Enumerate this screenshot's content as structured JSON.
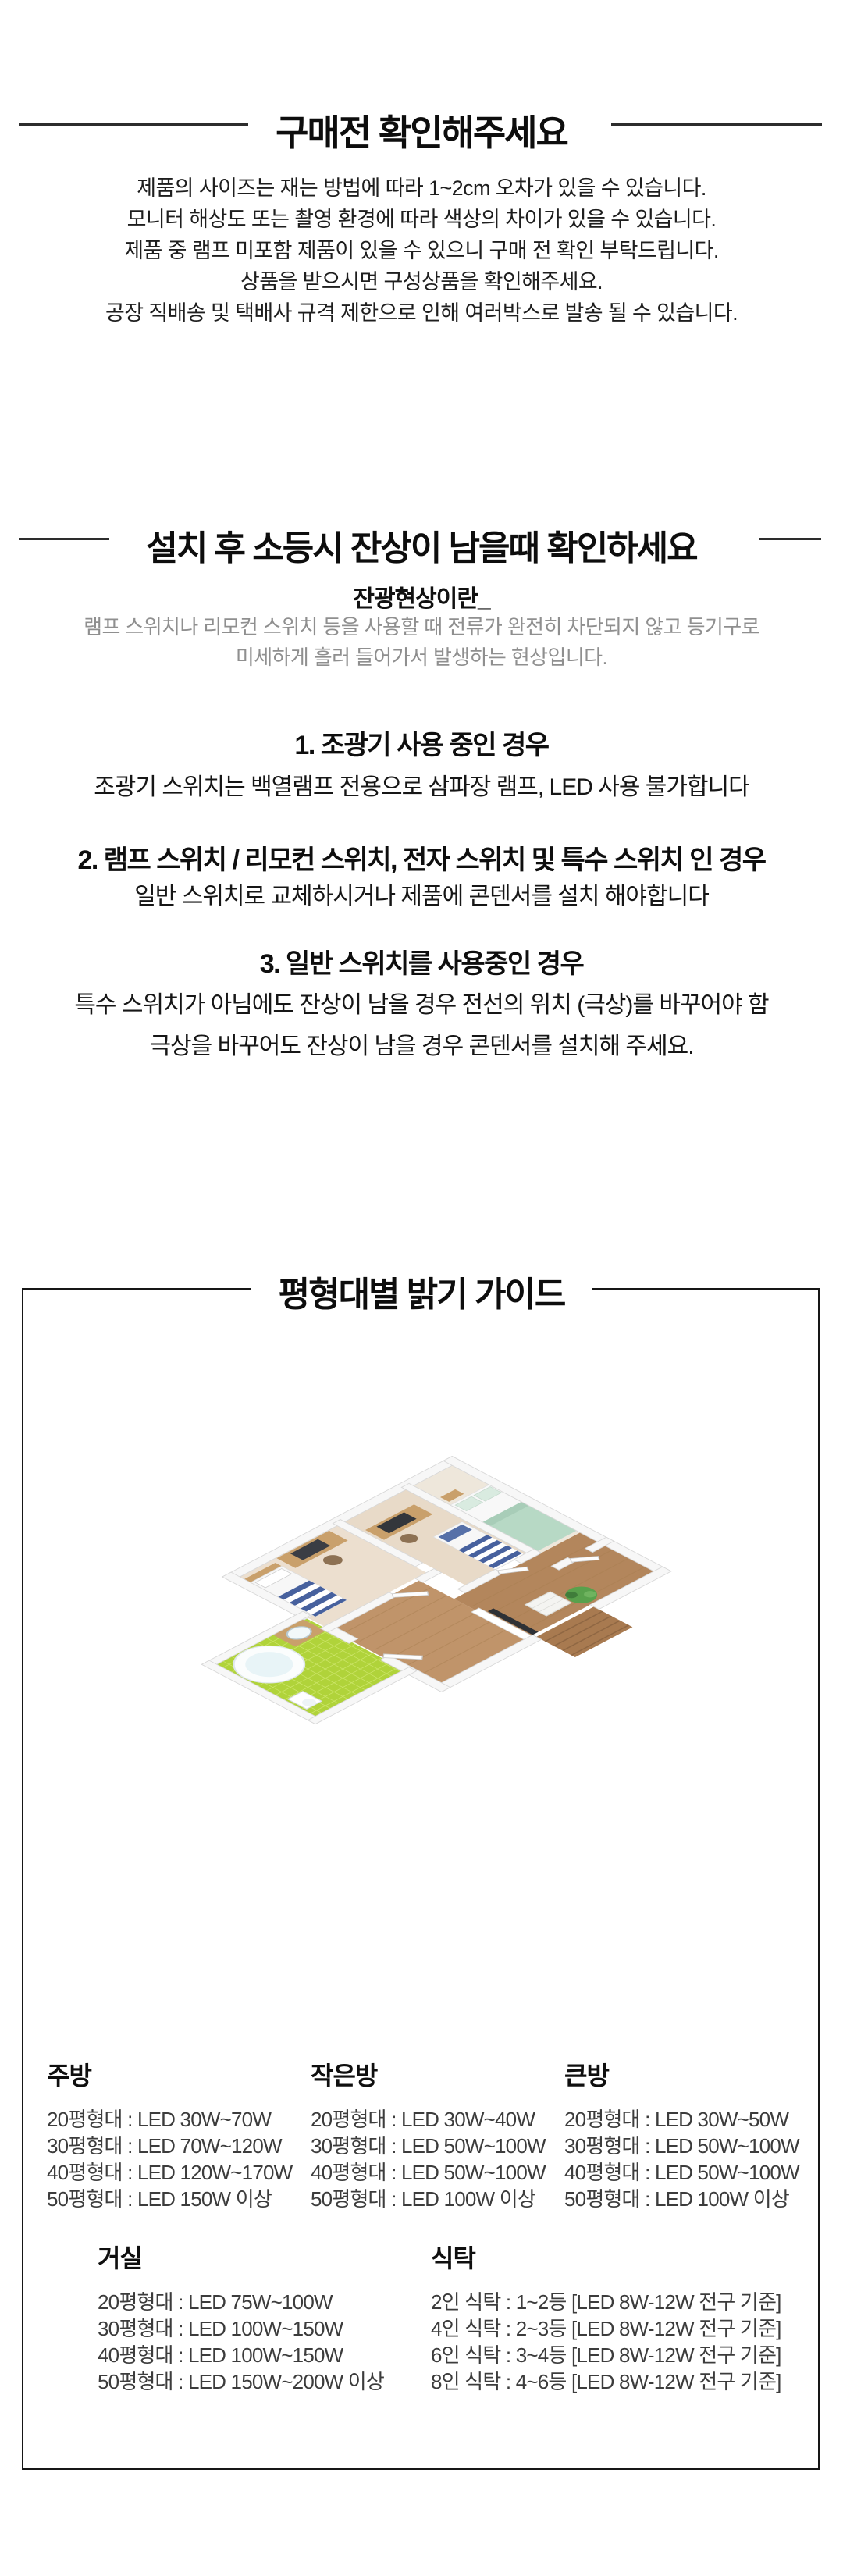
{
  "notice": {
    "title": "구매전 확인해주세요",
    "lines": [
      "제품의 사이즈는 재는 방법에 따라 1~2cm 오차가 있을 수 있습니다.",
      "모니터 해상도 또는 촬영 환경에 따라 색상의 차이가 있을 수 있습니다.",
      "제품 중 램프 미포함 제품이 있을 수 있으니 구매 전 확인 부탁드립니다.",
      "상품을 받으시면 구성상품을 확인해주세요.",
      "공장 직배송 및 택배사 규격 제한으로 인해 여러박스로 발송 될 수 있습니다."
    ]
  },
  "afterglow": {
    "title": "설치 후 소등시 잔상이 남을때 확인하세요",
    "subtitle": "잔광현상이란_",
    "desc_lines": [
      "램프 스위치나 리모컨 스위치 등을 사용할 때 전류가 완전히 차단되지 않고 등기구로",
      "미세하게 흘러 들어가서 발생하는 현상입니다."
    ],
    "cases": [
      {
        "heading": "1. 조광기 사용 중인 경우",
        "body1": "조광기 스위치는 백열램프 전용으로 삼파장 램프, LED 사용 불가합니다",
        "body2": ""
      },
      {
        "heading": "2. 램프 스위치 / 리모컨 스위치, 전자 스위치 및 특수 스위치 인 경우",
        "body1": "일반 스위치로 교체하시거나 제품에 콘덴서를 설치 해야합니다",
        "body2": ""
      },
      {
        "heading": "3. 일반 스위치를 사용중인 경우",
        "body1": "특수 스위치가 아님에도 잔상이 남을 경우 전선의 위치 (극상)를 바꾸어야 함",
        "body2": "극상을 바꾸어도 잔상이 남을 경우 콘덴서를 설치해 주세요."
      }
    ]
  },
  "guide": {
    "title": "평형대별 밝기 가이드",
    "illustration": "isometric-apartment-floorplan",
    "palette": {
      "bathroom_tile": "#b0d33a",
      "bathroom_tile_line": "#cde66b",
      "wood_floor": "#c0946a",
      "wood_floor_dark": "#b3865c",
      "pale_wood": "#ecdfcf",
      "wall_white": "#f7f7f7",
      "wall_edge": "#d8d8d8",
      "furniture_wood": "#c9a06b",
      "screen_dark": "#33363b",
      "bed_stripe_navy": "#47619e",
      "blanket_mint": "#b7d9c5",
      "plant_green": "#58a14c"
    },
    "row1": [
      {
        "name": "주방",
        "items": [
          "20평형대 : LED 30W~70W",
          "30평형대 : LED 70W~120W",
          "40평형대 : LED 120W~170W",
          "50평형대 : LED 150W 이상"
        ]
      },
      {
        "name": "작은방",
        "items": [
          "20평형대 : LED 30W~40W",
          "30평형대 : LED 50W~100W",
          "40평형대 : LED 50W~100W",
          "50평형대 : LED 100W 이상"
        ]
      },
      {
        "name": "큰방",
        "items": [
          "20평형대 : LED 30W~50W",
          "30평형대 : LED 50W~100W",
          "40평형대 : LED 50W~100W",
          "50평형대 : LED 100W 이상"
        ]
      }
    ],
    "row2": [
      {
        "name": "거실",
        "items": [
          "20평형대 : LED 75W~100W",
          "30평형대 : LED 100W~150W",
          "40평형대 : LED 100W~150W",
          "50평형대 : LED 150W~200W 이상"
        ]
      },
      {
        "name": "식탁",
        "items": [
          "2인 식탁 : 1~2등 [LED 8W-12W 전구 기준]",
          "4인 식탁 : 2~3등 [LED 8W-12W 전구 기준]",
          "6인 식탁 : 3~4등 [LED 8W-12W 전구 기준]",
          "8인 식탁 : 4~6등 [LED 8W-12W 전구 기준]"
        ]
      }
    ]
  }
}
